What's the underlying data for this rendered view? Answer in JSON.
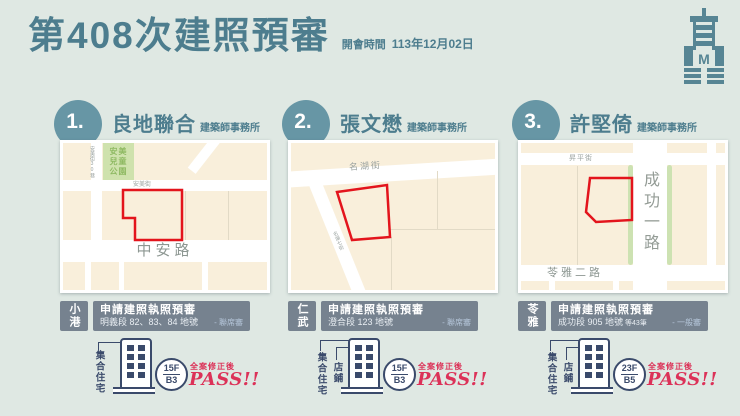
{
  "colors": {
    "background": "#dfe8e3",
    "accent_teal": "#4d7d8e",
    "circle_teal": "#6796a5",
    "bar_slate": "#76828f",
    "navy": "#3a4a6b",
    "parcel_red": "#e3141c",
    "pass_red": "#dc3158",
    "map_cream": "#f9efdb",
    "park_green": "#cfe2ad"
  },
  "header": {
    "title": "第408次建照預審",
    "meeting_label": "開會時間",
    "meeting_date": "113年12月02日",
    "logo": "kaohsiung-building-bureau-logo"
  },
  "panels": [
    {
      "number": "1.",
      "firm": "良地聯合",
      "firm_suffix": "建築師事務所",
      "district": "小港",
      "review_title": "申請建照執照預審",
      "lot": "明義段 82、83、84 地號",
      "lot_suffix": "",
      "review_type": "- 聯席審",
      "uses": [
        "集合住宅"
      ],
      "floors": "15F",
      "basement": "B3",
      "note": "全案修正後",
      "result": "PASS!!",
      "map": {
        "park_lines": [
          "安美",
          "兒童",
          "公園"
        ],
        "side_street": "安美街30巷",
        "top_street": "安美街",
        "main_road": "中安路"
      }
    },
    {
      "number": "2.",
      "firm": "張文懋",
      "firm_suffix": "建築師事務所",
      "district": "仁武",
      "review_title": "申請建照執照預審",
      "lot": "澄合段 123 地號",
      "lot_suffix": "",
      "review_type": "- 聯席審",
      "uses": [
        "集合住宅",
        "店鋪"
      ],
      "floors": "15F",
      "basement": "B3",
      "note": "全案修正後",
      "result": "PASS!!",
      "map": {
        "main_street": "名湖街",
        "side_street": "名湖七街"
      }
    },
    {
      "number": "3.",
      "firm": "許堅倚",
      "firm_suffix": "建築師事務所",
      "district": "苓雅",
      "review_title": "申請建照執照預審",
      "lot": "成功段 905 地號",
      "lot_suffix": "等43筆",
      "review_type": "- 一般審",
      "uses": [
        "集合住宅",
        "店鋪"
      ],
      "floors": "23F",
      "basement": "B5",
      "note": "全案修正後",
      "result": "PASS!!",
      "map": {
        "top_street": "昇平街",
        "right_road": "成功一路",
        "bottom_road": "苓雅二路"
      }
    }
  ]
}
